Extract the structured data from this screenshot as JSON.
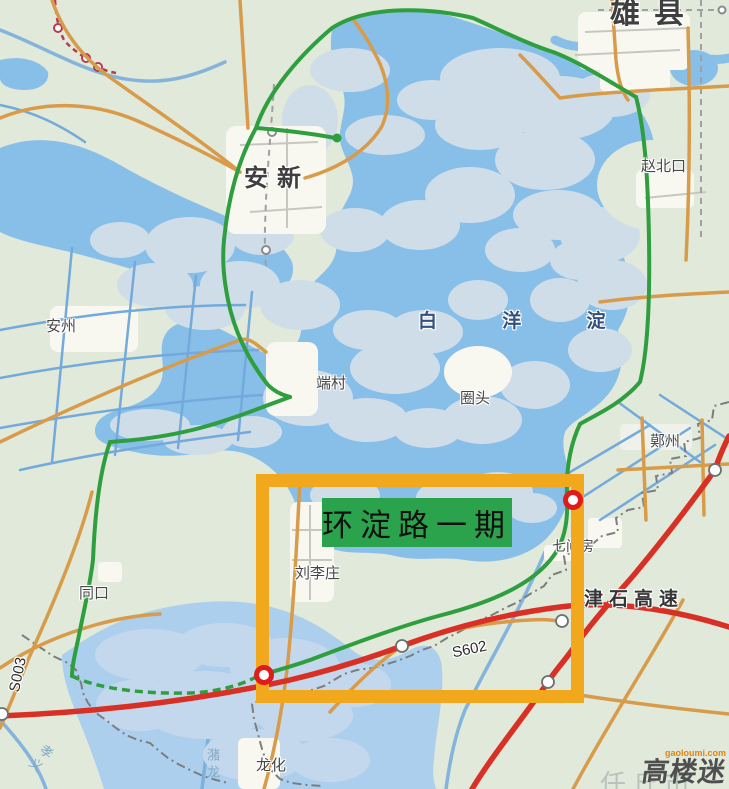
{
  "map": {
    "labels": {
      "xiongxian": "雄县",
      "zhaobeikou": "赵北口",
      "anxin": "安新",
      "anzhou": "安州",
      "baiyangdian": "白 洋 淀",
      "duancun": "端村",
      "quantou": "圈头",
      "maozhou": "鄚州",
      "qijianfang": "七间房",
      "liulizhuang": "刘李庄",
      "tongkou": "同口",
      "longhua": "龙化",
      "jinshi_expressway": "津石高速",
      "s602": "S602",
      "s003": "S003",
      "zhulong_river": "潴龙",
      "xiaoyi_river": "孝义",
      "renqiu": "任丘市"
    },
    "highlight": {
      "label": "环淀路一期"
    },
    "watermark": {
      "site": "gaoloumi.com",
      "name": "高楼迷"
    },
    "colors": {
      "land": "#e0e9da",
      "water": "#88bfe9",
      "water2": "#abcfec",
      "island": "#cfdde9",
      "island2": "#c3d8ec",
      "urban": "#f8f8f1",
      "canal": "#73aadb",
      "road-tan": "#d89b4a",
      "road-green": "#2f9e3e",
      "road-red": "#d93026",
      "rail-red": "#b83a52",
      "boundary": "#7d7d7d",
      "admin-dash": "#a0a0a0",
      "highlight": "#f2a81d",
      "label-green": "#2ba24c",
      "label-ink": "#111111",
      "town-label": "#474747",
      "water-label": "#33517e",
      "river-label": "#82a9c6",
      "expressway-label": "#353535",
      "pale-label": "#b7c3bb",
      "watermark-orange": "#e8820c",
      "watermark-gray": "#4f4f4f"
    }
  }
}
